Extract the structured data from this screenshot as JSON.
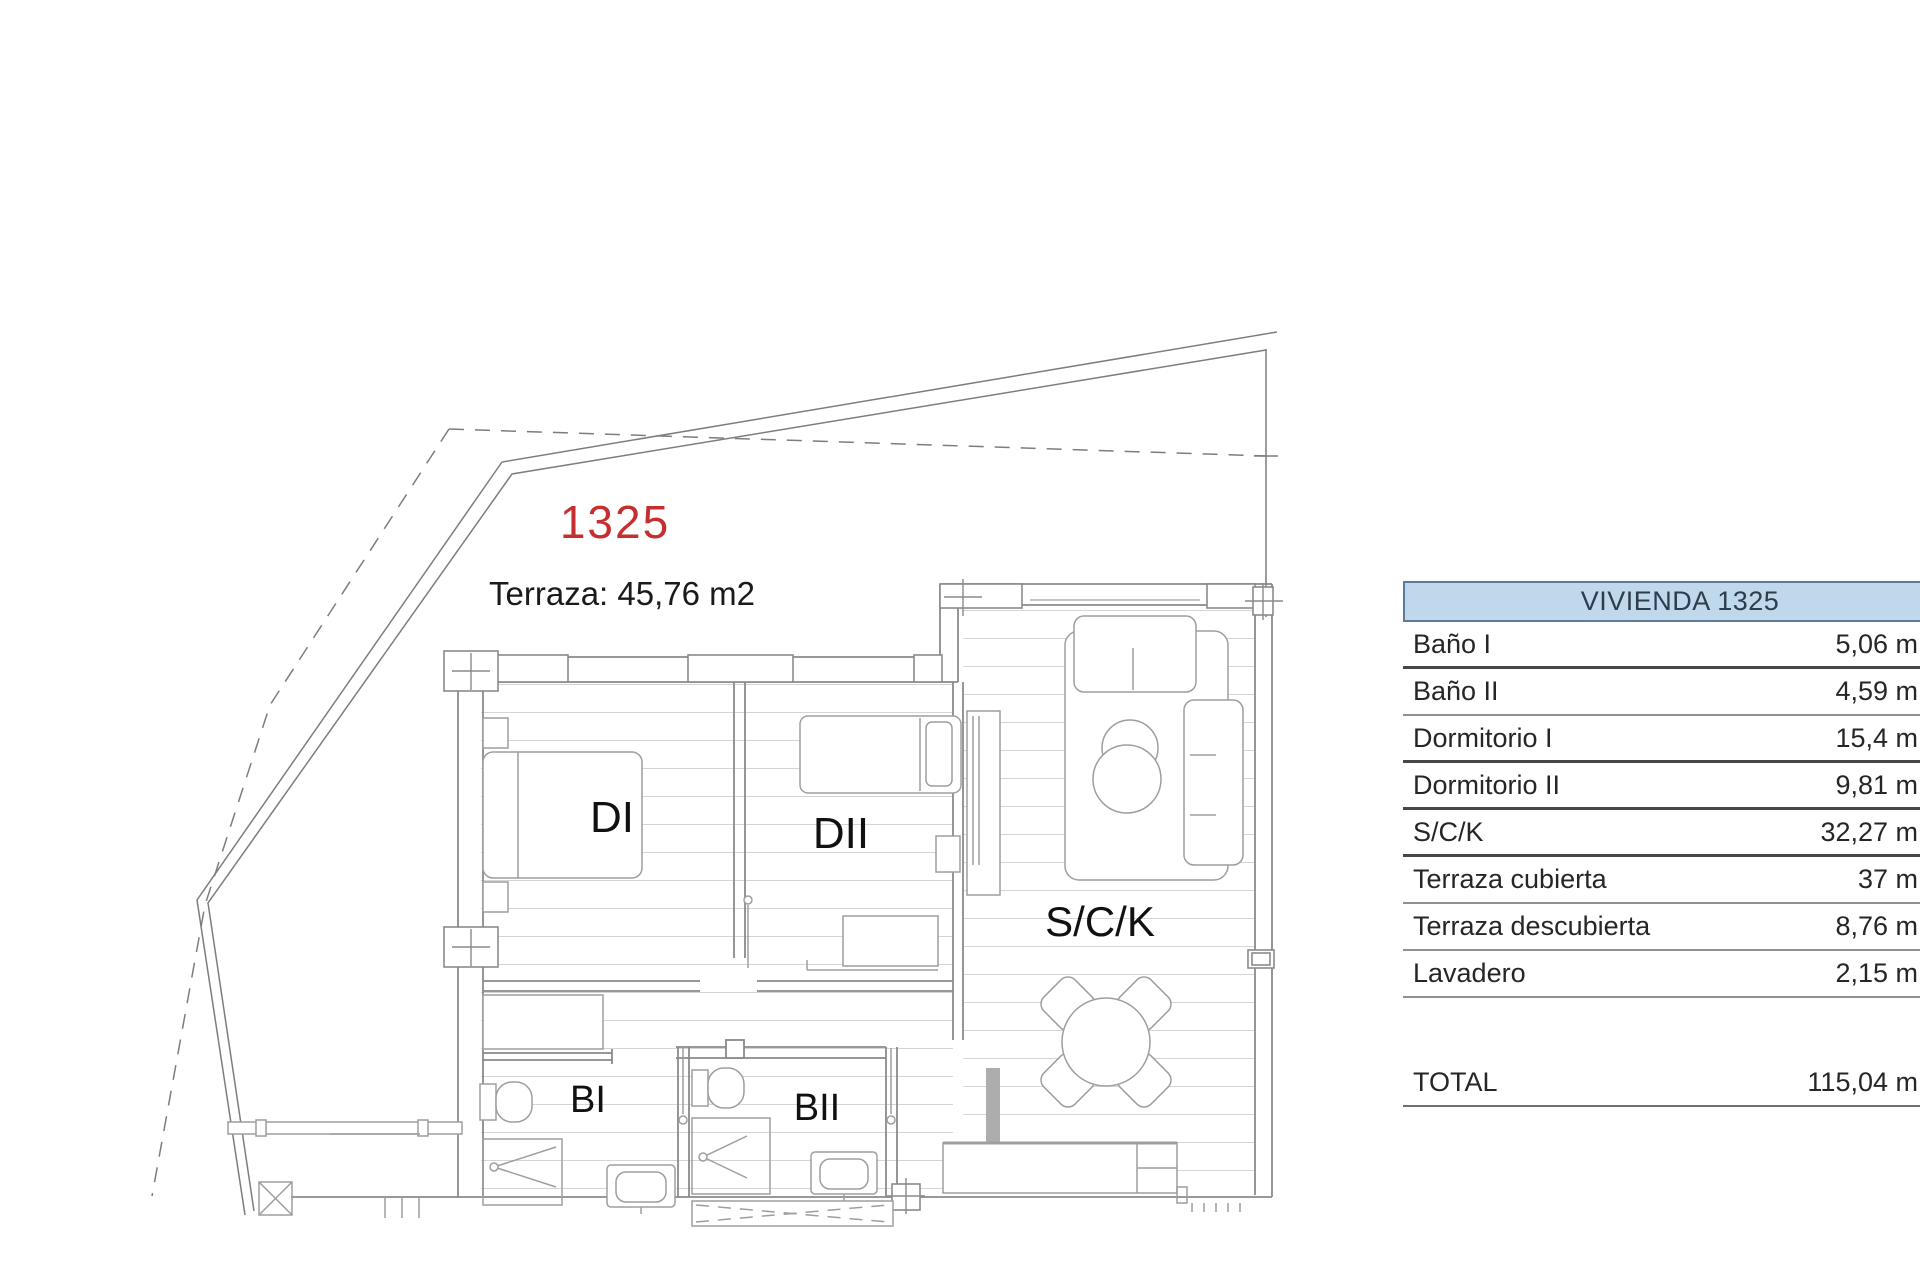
{
  "plan": {
    "unit_number": "1325",
    "terrace_label": "Terraza: 45,76 m2",
    "rooms": {
      "d1": "DI",
      "d2": "DII",
      "sck": "S/C/K",
      "b1": "BI",
      "b2": "BII"
    },
    "accent_red": "#c62f2f"
  },
  "table": {
    "header": "VIVIENDA 1325",
    "header_fill": "#bfd8ec",
    "rows": [
      {
        "label": "Baño I",
        "value": "5,06 m"
      },
      {
        "label": "Baño II",
        "value": "4,59 m"
      },
      {
        "label": "Dormitorio I",
        "value": "15,4 m"
      },
      {
        "label": "Dormitorio II",
        "value": "9,81 m"
      },
      {
        "label": "S/C/K",
        "value": "32,27 m"
      },
      {
        "label": "Terraza cubierta",
        "value": "37 m"
      },
      {
        "label": "Terraza descubierta",
        "value": "8,76 m"
      },
      {
        "label": "Lavadero",
        "value": "2,15 m"
      }
    ],
    "total_label": "TOTAL",
    "total_value": "115,04 m"
  }
}
